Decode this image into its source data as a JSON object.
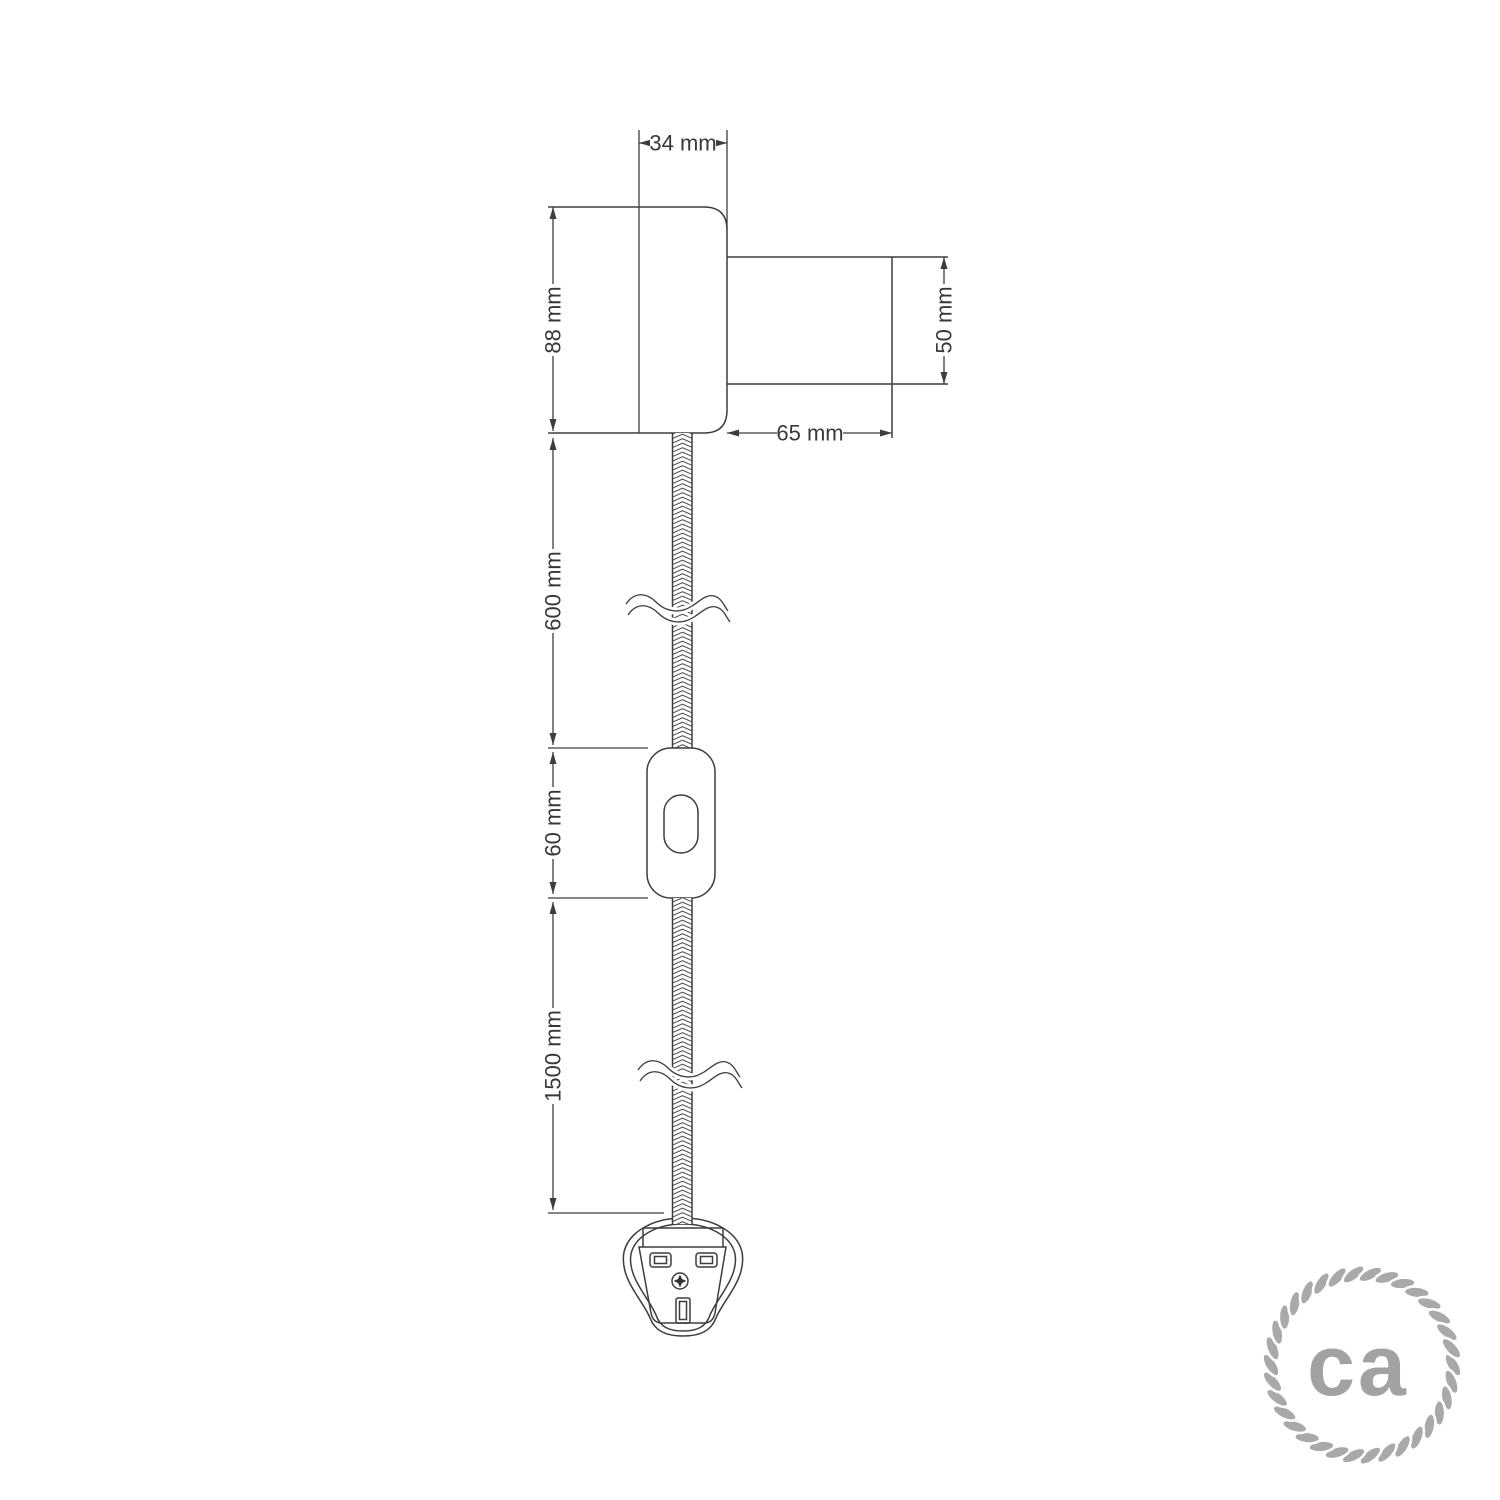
{
  "dims": {
    "d34": "34 mm",
    "d88": "88 mm",
    "d50": "50 mm",
    "d65": "65 mm",
    "d600": "600 mm",
    "d60": "60 mm",
    "d1500": "1500 mm"
  },
  "logo": {
    "text": "ca",
    "rope_color": "#a9a9a9",
    "text_color": "#a2a2a2"
  },
  "colors": {
    "line": "#3d3d3d",
    "background": "#ffffff"
  }
}
